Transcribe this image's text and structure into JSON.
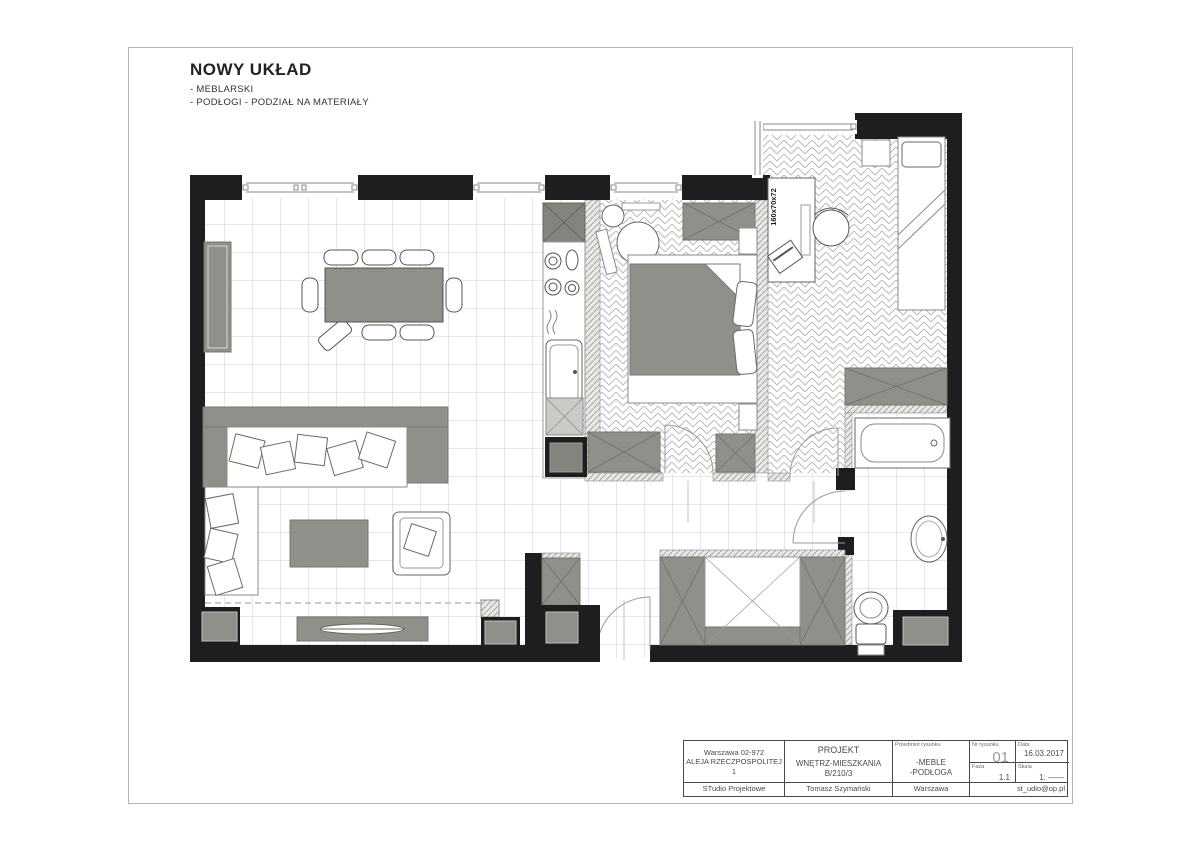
{
  "page": {
    "title": "NOWY UKŁAD",
    "subtitle_1": "- MEBLARSKI",
    "subtitle_2": "- PODŁOGI - PODZIAŁ NA MATERIAŁY"
  },
  "plan": {
    "desk_label": "160x70x72"
  },
  "title_block": {
    "address_line1": "Warszawa 02-972",
    "address_line2": "ALEJA RZECZPOSPOLITEJ 1",
    "project_line1": "PROJEKT",
    "project_line2": "WNĘTRZ-MIESZKANIA",
    "project_line3": "B/210/3",
    "subject_label": "Przedmiot rysunku",
    "subject_line1": "-MEBLE",
    "subject_line2": "-PODŁOGA",
    "drawing_no_label": "Nr rysunku",
    "drawing_no": "01",
    "phase_label": "Faza",
    "phase": "1.1",
    "date_label": "Data",
    "date": "16.03.2017",
    "scale_label": "Skala",
    "scale": "1: ——",
    "studio": "STudio Projektowe",
    "author": "Tomasz Szymański",
    "city": "Warszawa",
    "email": "st_udio@op.pl"
  },
  "colors": {
    "wall_black": "#1e1e1e",
    "furniture_gray": "#90908a",
    "fridge_gray": "#84847e",
    "tile_line": "#cfcfcf",
    "herringbone_line": "#b5b5b5",
    "page_border": "#b5b5b5"
  }
}
